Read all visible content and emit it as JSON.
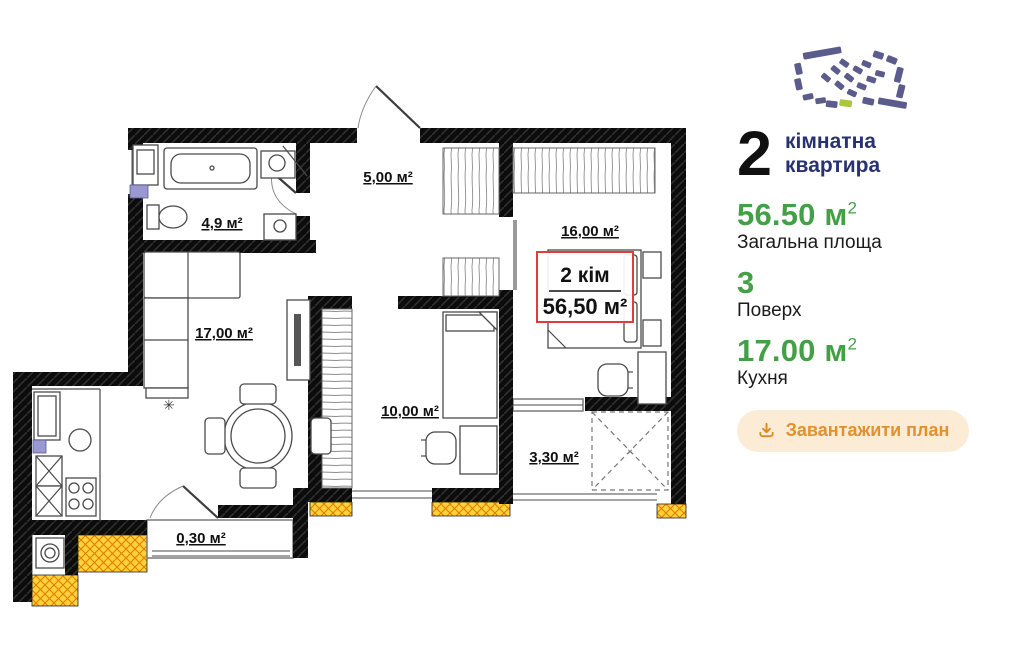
{
  "plan": {
    "rooms": [
      {
        "id": "bathroom",
        "label": "4,9 м²"
      },
      {
        "id": "hallway",
        "label": "5,00 м²"
      },
      {
        "id": "bedroom-large",
        "label": "16,00 м²"
      },
      {
        "id": "living-kitchen",
        "label": "17,00 м²"
      },
      {
        "id": "bedroom-small",
        "label": "10,00 м²"
      },
      {
        "id": "loggia",
        "label": "3,30 м²"
      },
      {
        "id": "balcony-small",
        "label": "0,30 м²"
      }
    ],
    "badge": {
      "line1": "2 кім",
      "line2": "56,50 м²"
    }
  },
  "panel": {
    "rooms_count": "2",
    "title": "кімнатна квартира",
    "stats": [
      {
        "value": "56.50 м",
        "sup": "2",
        "label": "Загальна площа"
      },
      {
        "value": "3",
        "sup": "",
        "label": "Поверх"
      },
      {
        "value": "17.00 м",
        "sup": "2",
        "label": "Кухня"
      }
    ],
    "download_button": "Завантажити план"
  },
  "colors": {
    "accent_green": "#43a047",
    "title_navy": "#283272",
    "button_bg": "#fcebd5",
    "button_text": "#e2912e",
    "badge_red": "#e23b3b",
    "insulation_yellow": "#ffd23c",
    "wall_black": "#0c0c0c",
    "minimap": "#5b5b8c",
    "minimap_highlight": "#a9c83a"
  }
}
